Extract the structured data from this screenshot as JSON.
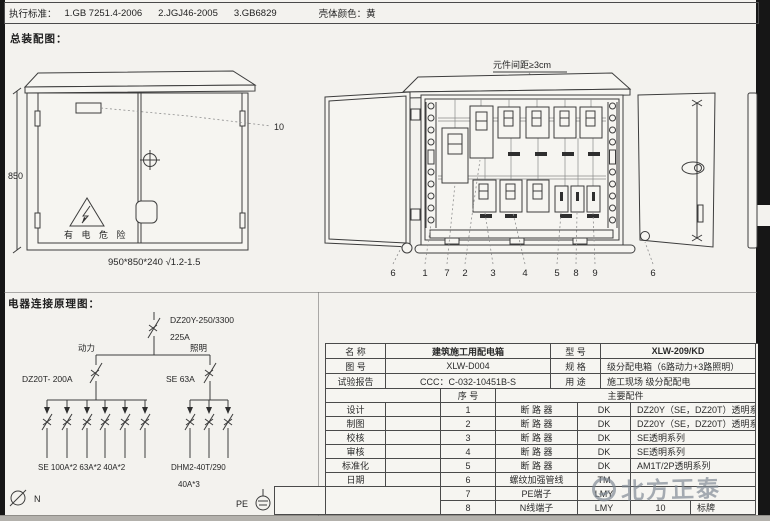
{
  "topbar": {
    "standard_label": "执行标准：",
    "standards": [
      "1.GB 7251.4-2006",
      "2.JGJ46-2005",
      "3.GB6829"
    ],
    "shell_color_label": "壳体颜色：",
    "shell_color_value": "黄"
  },
  "assembly": {
    "section_title": "总装配图：",
    "height_dim": "850",
    "size_caption": "950*850*240  √1.2-1.5",
    "hazard_text": "有 电 危 险",
    "callout_10": "10"
  },
  "layout_drawing": {
    "spacing_note": "元件间距≥3cm",
    "callouts": [
      "6",
      "1",
      "7",
      "2",
      "3",
      "4",
      "5",
      "8",
      "9",
      "6"
    ]
  },
  "schematic": {
    "section_title": "电器连接原理图：",
    "main_breaker_model": "DZ20Y-250/3300",
    "main_breaker_rating": "225A",
    "branch_left_label": "动力",
    "branch_right_label": "照明",
    "left_breaker": "DZ20T- 200A",
    "right_breaker": "SE  63A",
    "left_group_label": "SE 100A*2   63A*2   40A*2",
    "right_group_model": "DHM2-40T/290",
    "right_group_rating": "40A*3",
    "neutral_label": "N",
    "pe_label": "PE"
  },
  "info_table": {
    "fields": {
      "name_label": "名    称",
      "name_value": "建筑施工用配电箱",
      "model_label": "型    号",
      "model_value": "XLW-209/KD",
      "drawing_no_label": "图    号",
      "drawing_no_value": "XLW-D004",
      "spec_label": "规    格",
      "spec_value": "级分配电箱（6路动力+3路照明）",
      "report_label": "试验报告",
      "report_value": "CCC：C-032-10451B-S",
      "use_label": "用    途",
      "use_value": "施工现场  级分配配电"
    },
    "parts_header": {
      "seq": "序  号",
      "main_parts": "主要配件"
    },
    "titleblock": [
      "设计",
      "制图",
      "校核",
      "审核",
      "标准化",
      "日期"
    ],
    "parts": [
      {
        "num": "1",
        "name": "断  路  器",
        "code": "DK",
        "desc": "DZ20Y（SE，DZ20T）透明系列"
      },
      {
        "num": "2",
        "name": "断  路  器",
        "code": "DK",
        "desc": "DZ20Y（SE，DZ20T）透明系列"
      },
      {
        "num": "3",
        "name": "断  路  器",
        "code": "DK",
        "desc": "SE透明系列"
      },
      {
        "num": "4",
        "name": "断  路  器",
        "code": "DK",
        "desc": "SE透明系列"
      },
      {
        "num": "5",
        "name": "断  路  器",
        "code": "DK",
        "desc": "AM1T/2P透明系列"
      },
      {
        "num": "6",
        "name": "螺纹加强管线",
        "code": "TM",
        "desc": ""
      },
      {
        "num": "7",
        "name": "PE端子",
        "code": "LMY",
        "desc": ""
      },
      {
        "num": "8",
        "name": "N线端子",
        "code": "LMY",
        "num2": "10",
        "desc": "标牌"
      }
    ]
  },
  "watermark": {
    "text": "北方正泰"
  }
}
